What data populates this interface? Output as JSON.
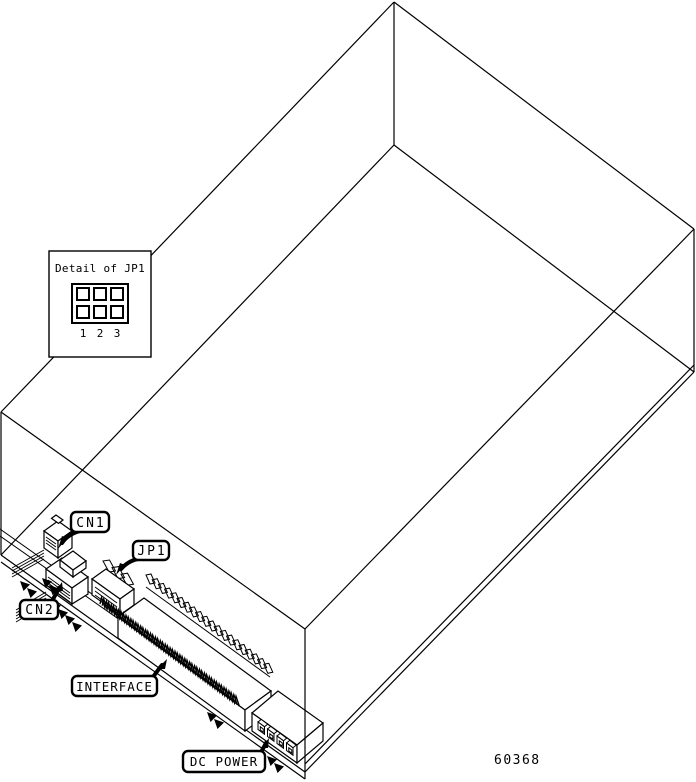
{
  "diagram": {
    "background_color": "#ffffff",
    "line_color": "#000000",
    "part_number": "60368",
    "detail_inset": {
      "title": "Detail of JP1",
      "pin_labels": [
        "1",
        "2",
        "3"
      ]
    },
    "callouts": {
      "cn1": "CN1",
      "jp1": "JP1",
      "cn2": "CN2",
      "interface": "INTERFACE",
      "dc_power": "DC POWER"
    }
  }
}
